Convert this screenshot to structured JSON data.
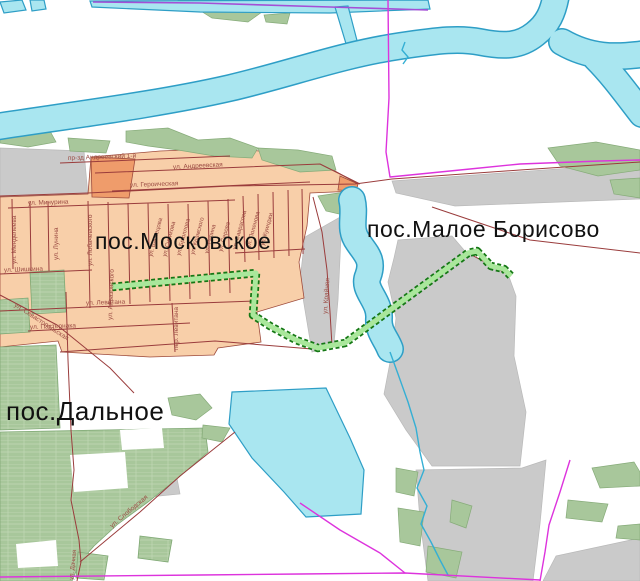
{
  "map": {
    "settlements": {
      "moskovskoye": "пос.Московское",
      "maloye_borisovo": "пос.Малое Борисово",
      "dalnoye": "пос.Дальное"
    },
    "streets": {
      "andreevsky_proezd": "пр-зд Андреевский 1-й",
      "andreevskaya": "ул. Андреевская",
      "geroicheskaya": "ул. Героическая",
      "michurina": "ул. Мичурина",
      "shishkina": "ул. Шишкина",
      "levitana": "ул. Левитана",
      "levitana_lane": "пер. Левитана",
      "pasternaka": "ул. Пастернака",
      "mendeleeva": "ул. Менделеева",
      "lunina": "ул. Лунина",
      "lobachevskogo": "ул. Лобачевского",
      "ayvazovskogo": "ул. Айвазовского",
      "vasnetsova": "ул. Васнецова",
      "surikova": "ул. Сурикова",
      "bryullova": "ул. Брюллова",
      "kramskogo": "ул. Крамского",
      "repina": "ул. Репина",
      "serova": "ул. Серова",
      "savrasova": "ул. Саврасова",
      "polenova": "ул. Поленова",
      "kuindzhi": "ул. Куинджи",
      "kraynyaya": "ул. Крайняя",
      "sevastopolskaya": "ул. Севастопольская",
      "slobodskaya": "ул. Слободская",
      "dachnaya": "ул. Дачная"
    },
    "colors": {
      "water_fill": "#A9E6F0",
      "water_stroke": "#2E9EC6",
      "vegetation": "#A8C79B",
      "residential": "#F8CFA9",
      "residential_dark": "#EF9C6B",
      "industrial_gray": "#CACACA",
      "road": "#9A3C3C",
      "boundary_magenta": "#DD33DD",
      "boundary_purple": "#A44FD6",
      "route_highlight_fill": "#A9E79B",
      "route_highlight_stroke": "#157815",
      "street_label": "#9A4A42",
      "settlement_label": "#111111"
    }
  }
}
